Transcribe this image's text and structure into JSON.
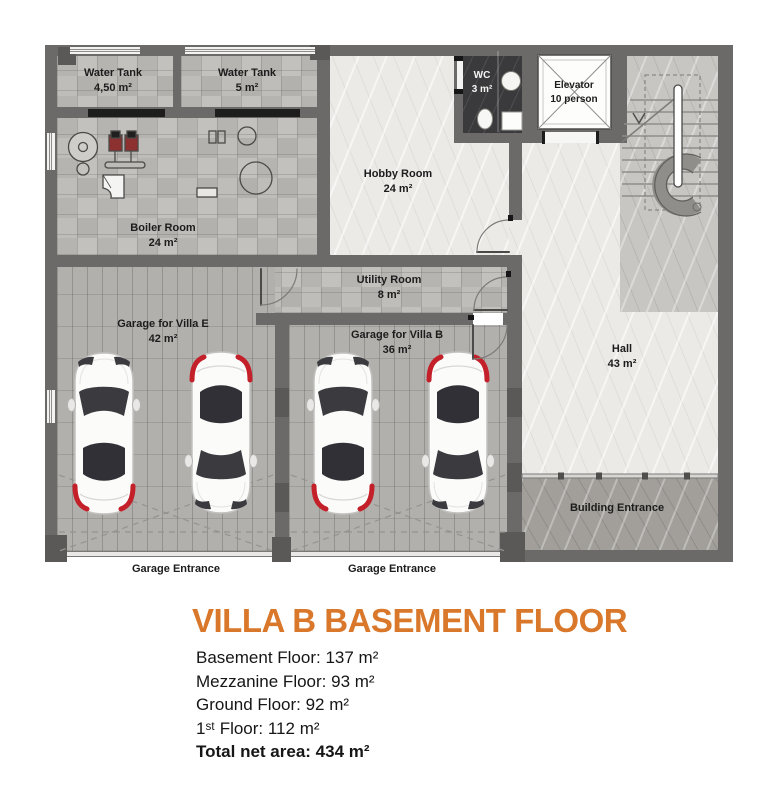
{
  "colors": {
    "accent": "#d9782a",
    "wall": "#6b6a68",
    "car_red": "#c3202a",
    "lintel": "#1d1d1d"
  },
  "rooms": {
    "water_tank_1": {
      "name": "Water Tank",
      "area": "4,50 m²"
    },
    "water_tank_2": {
      "name": "Water Tank",
      "area": "5 m²"
    },
    "boiler_room": {
      "name": "Boiler Room",
      "area": "24 m²"
    },
    "hobby_room": {
      "name": "Hobby Room",
      "area": "24 m²"
    },
    "wc": {
      "name": "WC",
      "area": "3 m²"
    },
    "elevator": {
      "name": "Elevator",
      "capacity": "10 person"
    },
    "utility_room": {
      "name": "Utility Room",
      "area": "8 m²"
    },
    "garage_villa_e": {
      "name": "Garage for Villa E",
      "area": "42 m²"
    },
    "garage_villa_b": {
      "name": "Garage for Villa B",
      "area": "36 m²"
    },
    "hall": {
      "name": "Hall",
      "area": "43 m²"
    },
    "building_entrance": {
      "name": "Building Entrance"
    },
    "garage_entrance_left": {
      "name": "Garage Entrance"
    },
    "garage_entrance_right": {
      "name": "Garage Entrance"
    }
  },
  "title": "VILLA B BASEMENT FLOOR",
  "summary": {
    "lines": [
      "Basement Floor: 137 m²",
      "Mezzanine Floor: 93 m²",
      "Ground Floor: 92 m²",
      "1ˢᵗ Floor: 112 m²"
    ],
    "total": "Total net area: 434 m²"
  }
}
